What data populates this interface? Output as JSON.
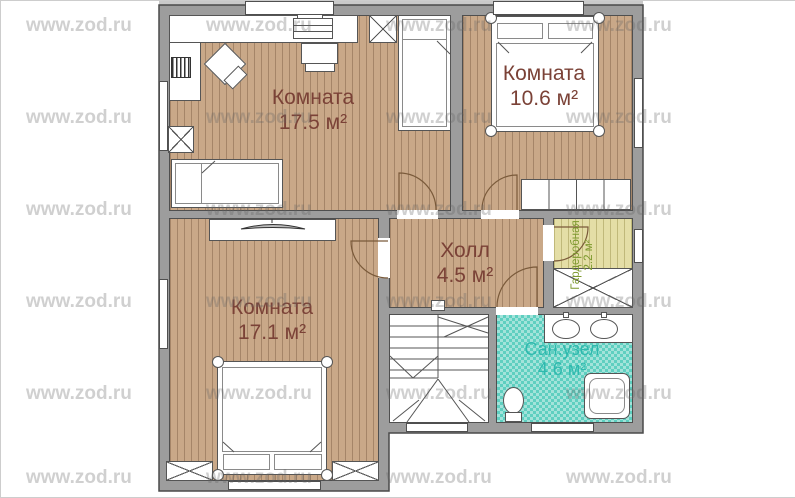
{
  "watermark": {
    "text": "www.zod.ru"
  },
  "rooms": [
    {
      "name": "Комната",
      "area": "17.5 м²"
    },
    {
      "name": "Комната",
      "area": "10.6 м²"
    },
    {
      "name": "Комната",
      "area": "17.1 м²"
    },
    {
      "name": "Холл",
      "area": "4.5 м²"
    },
    {
      "name": "Сан.узел",
      "area": "4.6 м²"
    },
    {
      "name": "Гардеробная",
      "area": "2.2 м²"
    }
  ],
  "colors": {
    "wall": "#9D9D9D",
    "floor_room": "#C9A888",
    "floor_wardrobe": "#E4DEA6",
    "floor_bath": "#5ECFC0",
    "label_room": "#7B4237",
    "label_bath": "#2FB9AE",
    "label_wardrobe": "#7E9A2F",
    "door": "#7A5A3A",
    "outline": "#4A4A4A"
  }
}
